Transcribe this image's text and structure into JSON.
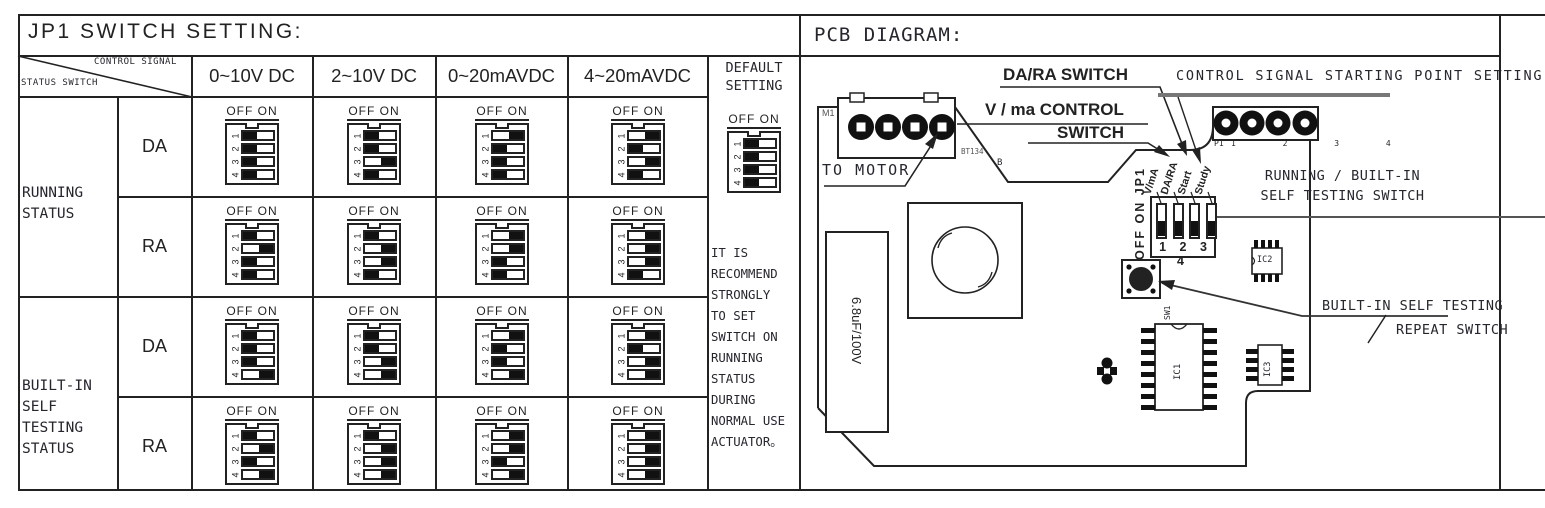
{
  "table": {
    "title": "JP1 SWITCH SETTING:",
    "corner_top": "CONTROL SIGNAL",
    "corner_bottom": "STATUS SWITCH",
    "columns": [
      "0~10V DC",
      "2~10V DC",
      "0~20mAVDC",
      "4~20mAVDC"
    ],
    "default_header": "DEFAULT\nSETTING",
    "dip_legend": "OFF ON",
    "dip_numbers": [
      "1",
      "2",
      "3",
      "4"
    ],
    "groups": [
      {
        "label": "RUNNING\nSTATUS",
        "rows": [
          {
            "label": "DA",
            "cells": [
              [
                0,
                0,
                0,
                0
              ],
              [
                0,
                0,
                1,
                0
              ],
              [
                1,
                0,
                0,
                0
              ],
              [
                1,
                0,
                1,
                0
              ]
            ]
          },
          {
            "label": "RA",
            "cells": [
              [
                0,
                1,
                0,
                0
              ],
              [
                0,
                1,
                1,
                0
              ],
              [
                1,
                1,
                0,
                0
              ],
              [
                1,
                1,
                1,
                0
              ]
            ]
          }
        ]
      },
      {
        "label": "BUILT-IN\nSELF\nTESTING\nSTATUS",
        "rows": [
          {
            "label": "DA",
            "cells": [
              [
                0,
                0,
                0,
                1
              ],
              [
                0,
                0,
                1,
                1
              ],
              [
                1,
                0,
                0,
                1
              ],
              [
                1,
                0,
                1,
                1
              ]
            ]
          },
          {
            "label": "RA",
            "cells": [
              [
                0,
                1,
                0,
                1
              ],
              [
                0,
                1,
                1,
                1
              ],
              [
                1,
                1,
                0,
                1
              ],
              [
                1,
                1,
                1,
                1
              ]
            ]
          }
        ]
      }
    ],
    "default_setting": [
      0,
      0,
      0,
      0
    ],
    "note": "IT IS\nRECOMMEND\nSTRONGLY\nTO SET\nSWITCH ON\nRUNNING\nSTATUS\nDURING\nNORMAL USE\nACTUATOR。"
  },
  "pcb": {
    "title": "PCB DIAGRAM:",
    "da_ra_switch_label": "DA/RA SWITCH",
    "control_signal_label": "CONTROL SIGNAL STARTING POINT SETTING",
    "v_ma_label_line1": "V / ma CONTROL",
    "v_ma_label_line2": "SWITCH",
    "to_motor_label": "TO MOTOR",
    "bt134_label": "BT134",
    "b_label": "B",
    "m1_label": "M1",
    "p1_label": "P1",
    "p1_pins": "1 2 3 4",
    "off_on_jp1_label": "OFF ON JP1",
    "jp1_numbers": "1 2 3 4",
    "jp1_states": [
      0,
      0,
      0,
      0
    ],
    "sw_labels": [
      "V/mA",
      "DA/RA",
      "Start",
      "Study"
    ],
    "running_switch_label": "RUNNING / BUILT-IN\nSELF TESTING SWITCH",
    "repeat_switch_line1": "BUILT-IN SELF TESTING",
    "repeat_switch_line2": "REPEAT SWITCH",
    "capacitor_label": "6.8uF/100V",
    "sw1_label": "SW1",
    "ic1_label": "IC1",
    "ic2_label": "IC2",
    "ic3_label": "IC3"
  },
  "colors": {
    "line": "#222222",
    "text": "#26262e",
    "thick_leader": "#777777",
    "slider": "#111111"
  }
}
